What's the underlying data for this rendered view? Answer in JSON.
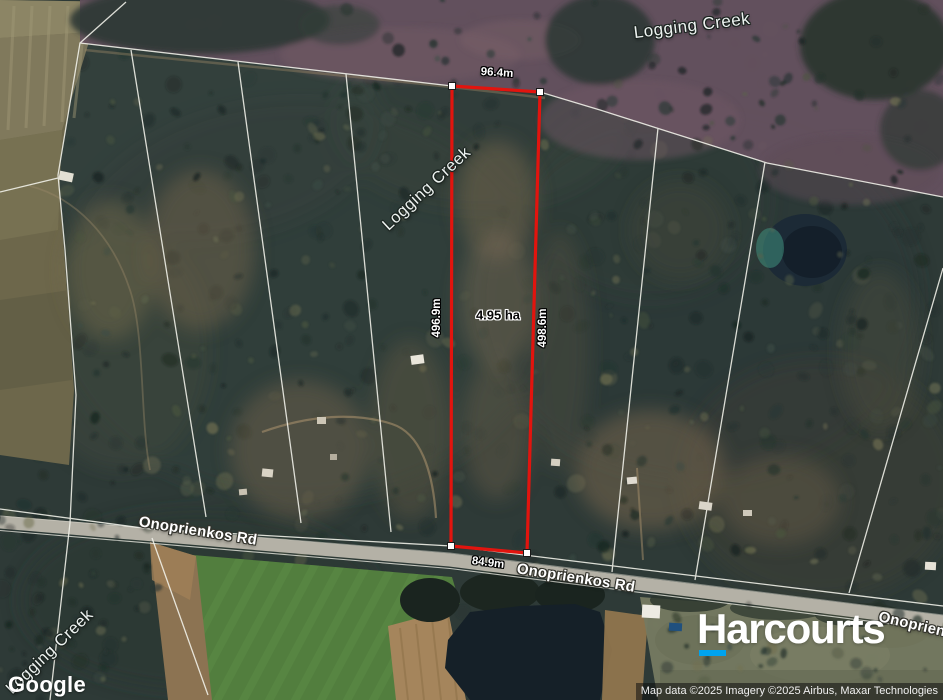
{
  "map": {
    "place_labels": {
      "creek_top": "Logging Creek",
      "creek_mid": "Logging Creek",
      "creek_bottom": "Logging Creek",
      "road_left": "Onoprienkos Rd",
      "road_center": "Onoprienkos Rd",
      "road_right": "Onoprienkos Rd"
    },
    "parcel": {
      "area_label": "4.95 ha",
      "length_top": "96.4m",
      "length_left": "496.9m",
      "length_right": "498.6m",
      "length_bottom": "84.9m",
      "outline_color": "#e2140e"
    },
    "google_watermark": "Google",
    "branding": {
      "name": "Harcourts",
      "accent_color": "#00a3ee"
    },
    "attribution": "Map data ©2025 Imagery ©2025 Airbus, Maxar Technologies"
  }
}
